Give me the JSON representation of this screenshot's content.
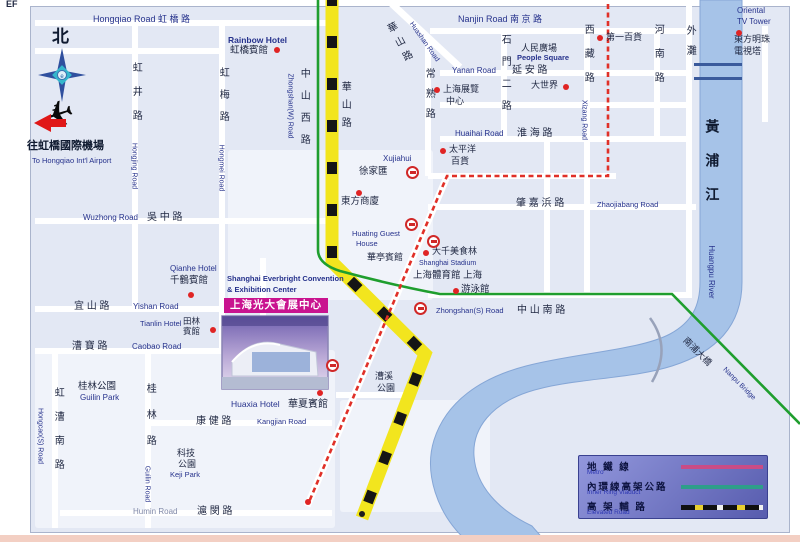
{
  "window": {
    "corner_text": "EF"
  },
  "colors": {
    "metro_line": "#e03028",
    "inner_ring_viaduct": "#1f9e2e",
    "elevated_road_yellow": "#f2e51e",
    "river": "#a6c3e8",
    "banner": "#c9138f",
    "landmark_dot": "#e02424",
    "navy_text": "#26328c"
  },
  "convention": {
    "en_line1": "Shanghai Everbright Convention",
    "en_line2": "& Exhibition Center",
    "banner": "上海光大會展中心"
  },
  "legend": {
    "rows": [
      {
        "zh": "地 鐵 線",
        "en": "Metro",
        "type": "metro"
      },
      {
        "zh": "內環線高架公路",
        "en": "Inner Ring Viaduct",
        "type": "ring"
      },
      {
        "zh": "高 架 輔 路",
        "en": "Elevated Road",
        "type": "elevated"
      }
    ]
  },
  "labels": [
    {
      "n": "corner-ef",
      "t": "EF",
      "x": 6,
      "y": 0,
      "fs": 9,
      "b": 1
    },
    {
      "n": "road-hongqiao",
      "t": "Hongqiao Road 虹 橋 路",
      "x": 93,
      "y": 15,
      "fs": 9,
      "c": "navy"
    },
    {
      "n": "compass-north",
      "t": "北",
      "x": 52,
      "y": 28,
      "fs": 17,
      "b": 1,
      "c": "dark2"
    },
    {
      "n": "airport-zh",
      "t": "往虹橋國際機場",
      "x": 27,
      "y": 141,
      "fs": 11,
      "b": 1,
      "c": "dark2"
    },
    {
      "n": "airport-en",
      "t": "To Hongqiao Int'l Airport",
      "x": 32,
      "y": 157,
      "fs": 7.5,
      "c": "navy"
    },
    {
      "n": "road-hongjing-zh",
      "t": "虹井路",
      "x": 135,
      "y": 98,
      "fs": 10,
      "v": 1,
      "ls": 14
    },
    {
      "n": "road-hongjing-en",
      "t": "Hongjing Road",
      "x": 134,
      "y": 166,
      "fs": 7,
      "rot": 90,
      "c": "navy"
    },
    {
      "n": "road-hongmei-zh",
      "t": "虹梅路",
      "x": 222,
      "y": 100,
      "fs": 10,
      "v": 1,
      "ls": 12
    },
    {
      "n": "road-hongmei-en",
      "t": "Hongmei Road",
      "x": 221,
      "y": 168,
      "fs": 7,
      "rot": 90,
      "c": "navy"
    },
    {
      "n": "road-zhongshanw-zh",
      "t": "中山西路",
      "x": 303,
      "y": 112,
      "fs": 10,
      "v": 1,
      "ls": 12
    },
    {
      "n": "road-zhongshanw-en",
      "t": "Zhongshan(W) Road",
      "x": 290,
      "y": 106,
      "fs": 7,
      "rot": 90,
      "c": "navy"
    },
    {
      "n": "rainbow-hotel-en",
      "t": "Rainbow Hotel",
      "x": 228,
      "y": 36,
      "fs": 8.5,
      "b": 1,
      "c": "navy"
    },
    {
      "n": "rainbow-hotel-zh",
      "t": "虹橋賓館",
      "x": 230,
      "y": 46,
      "fs": 9.5
    },
    {
      "n": "road-huashan-diag-zh",
      "t": "華山路",
      "x": 399,
      "y": 45,
      "fs": 10,
      "v": 1,
      "rot": -28,
      "ls": 6
    },
    {
      "n": "road-huashan-diag-en",
      "t": "Huashan Road",
      "x": 424,
      "y": 42,
      "fs": 7,
      "rot": 55,
      "c": "navy"
    },
    {
      "n": "road-huashan-zh",
      "t": "華山路",
      "x": 344,
      "y": 108,
      "fs": 10,
      "v": 1,
      "ls": 8
    },
    {
      "n": "road-changshu-zh",
      "t": "常熟路",
      "x": 428,
      "y": 98,
      "fs": 10,
      "v": 1,
      "ls": 10
    },
    {
      "n": "road-nanjing",
      "t": "Nanjin Road 南 京 路",
      "x": 458,
      "y": 15,
      "fs": 9,
      "c": "navy"
    },
    {
      "n": "road-shimen-zh",
      "t": "石門二路",
      "x": 504,
      "y": 78,
      "fs": 10,
      "v": 1,
      "ls": 12
    },
    {
      "n": "people-square-zh",
      "t": "人民廣場",
      "x": 521,
      "y": 44,
      "fs": 9
    },
    {
      "n": "people-square-en",
      "t": "People Square",
      "x": 517,
      "y": 54,
      "fs": 7.5,
      "b": 1,
      "c": "navy"
    },
    {
      "n": "road-yanan-en",
      "t": "Yanan Road",
      "x": 452,
      "y": 67,
      "fs": 8,
      "c": "navy"
    },
    {
      "n": "road-yanan-zh",
      "t": "延 安 路",
      "x": 512,
      "y": 66,
      "fs": 10
    },
    {
      "n": "great-world-zh",
      "t": "大世界",
      "x": 531,
      "y": 81,
      "fs": 9
    },
    {
      "n": "exhibition-zh",
      "t": "上海展覽",
      "x": 443,
      "y": 85,
      "fs": 9
    },
    {
      "n": "exhibition-zh2",
      "t": "中心",
      "x": 446,
      "y": 97,
      "fs": 9
    },
    {
      "n": "road-xizang-zh",
      "t": "西藏路",
      "x": 587,
      "y": 60,
      "fs": 10,
      "v": 1,
      "ls": 14
    },
    {
      "n": "road-xizang-en",
      "t": "Xizang Road",
      "x": 584,
      "y": 120,
      "fs": 7,
      "rot": 90,
      "c": "navy"
    },
    {
      "n": "no1-store-zh",
      "t": "第一百貨",
      "x": 606,
      "y": 33,
      "fs": 9
    },
    {
      "n": "road-henan-zh",
      "t": "河南路",
      "x": 657,
      "y": 60,
      "fs": 10,
      "v": 1,
      "ls": 14
    },
    {
      "n": "bund-zh",
      "t": "外灘",
      "x": 689,
      "y": 45,
      "fs": 10,
      "v": 1,
      "ls": 10
    },
    {
      "n": "oriental-en1",
      "t": "Oriental",
      "x": 737,
      "y": 7,
      "fs": 8,
      "c": "navy"
    },
    {
      "n": "oriental-en2",
      "t": "TV Tower",
      "x": 737,
      "y": 18,
      "fs": 8,
      "c": "navy"
    },
    {
      "n": "oriental-zh1",
      "t": "東方明珠",
      "x": 734,
      "y": 35,
      "fs": 9
    },
    {
      "n": "oriental-zh2",
      "t": "電視塔",
      "x": 734,
      "y": 47,
      "fs": 9
    },
    {
      "n": "road-huaihai-en",
      "t": "Huaihai Road",
      "x": 455,
      "y": 130,
      "fs": 8,
      "c": "navy"
    },
    {
      "n": "road-huaihai-zh",
      "t": "淮 海 路",
      "x": 517,
      "y": 129,
      "fs": 10
    },
    {
      "n": "pacific-zh1",
      "t": "太平洋",
      "x": 449,
      "y": 145,
      "fs": 9
    },
    {
      "n": "pacific-zh2",
      "t": "百貨",
      "x": 451,
      "y": 157,
      "fs": 9
    },
    {
      "n": "xujiahui-en",
      "t": "Xujiahui",
      "x": 383,
      "y": 155,
      "fs": 8,
      "c": "navy"
    },
    {
      "n": "xujiahui-zh",
      "t": "徐家匯",
      "x": 359,
      "y": 167,
      "fs": 9.5
    },
    {
      "n": "road-zhaojiabang-zh",
      "t": "肇 嘉 浜 路",
      "x": 516,
      "y": 199,
      "fs": 10
    },
    {
      "n": "road-zhaojiabang-en",
      "t": "Zhaojiabang Road",
      "x": 597,
      "y": 201,
      "fs": 7.5,
      "c": "navy"
    },
    {
      "n": "oriental-mall-zh",
      "t": "東方商廈",
      "x": 341,
      "y": 197,
      "fs": 9.5
    },
    {
      "n": "road-wuzhong-en",
      "t": "Wuzhong Road",
      "x": 83,
      "y": 214,
      "fs": 8,
      "c": "navy"
    },
    {
      "n": "road-wuzhong-zh",
      "t": "吳 中 路",
      "x": 147,
      "y": 213,
      "fs": 10
    },
    {
      "n": "huating-en1",
      "t": "Huating Guest",
      "x": 352,
      "y": 230,
      "fs": 7.5,
      "c": "navy"
    },
    {
      "n": "huating-en2",
      "t": "House",
      "x": 356,
      "y": 240,
      "fs": 7.5,
      "c": "navy"
    },
    {
      "n": "huating-zh",
      "t": "華亭賓館",
      "x": 367,
      "y": 253,
      "fs": 9
    },
    {
      "n": "daqian-zh",
      "t": "大千美食林",
      "x": 432,
      "y": 247,
      "fs": 9
    },
    {
      "n": "stadium-en",
      "t": "Shanghai Stadium",
      "x": 419,
      "y": 260,
      "fs": 7,
      "c": "navy"
    },
    {
      "n": "stadium-zh",
      "t": "上海體育館 上海",
      "x": 413,
      "y": 271,
      "fs": 9.5
    },
    {
      "n": "natatorium-zh",
      "t": "游泳館",
      "x": 461,
      "y": 285,
      "fs": 9.5
    },
    {
      "n": "qianhe-en",
      "t": "Qianhe Hotel",
      "x": 170,
      "y": 265,
      "fs": 8,
      "c": "navy"
    },
    {
      "n": "qianhe-zh",
      "t": "千鶴賓館",
      "x": 170,
      "y": 276,
      "fs": 9.5
    },
    {
      "n": "road-zhongshans-en",
      "t": "Zhongshan(S) Road",
      "x": 436,
      "y": 307,
      "fs": 7.5,
      "c": "navy"
    },
    {
      "n": "road-zhongshans-zh",
      "t": "中 山 南 路",
      "x": 517,
      "y": 306,
      "fs": 10
    },
    {
      "n": "road-yishan-zh",
      "t": "宜 山 路",
      "x": 74,
      "y": 302,
      "fs": 10
    },
    {
      "n": "road-yishan-en",
      "t": "Yishan Road",
      "x": 133,
      "y": 303,
      "fs": 8,
      "c": "navy"
    },
    {
      "n": "tianlin-en",
      "t": "Tianlin Hotel",
      "x": 140,
      "y": 320,
      "fs": 7.5,
      "c": "navy"
    },
    {
      "n": "tianlin-zh1",
      "t": "田林",
      "x": 183,
      "y": 317,
      "fs": 8.5
    },
    {
      "n": "tianlin-zh2",
      "t": "賓館",
      "x": 183,
      "y": 327,
      "fs": 8.5
    },
    {
      "n": "road-caobao-zh",
      "t": "漕 寶 路",
      "x": 72,
      "y": 342,
      "fs": 10
    },
    {
      "n": "road-caobao-en",
      "t": "Caobao Road",
      "x": 132,
      "y": 343,
      "fs": 8,
      "c": "navy"
    },
    {
      "n": "caoxi-park-zh1",
      "t": "漕溪",
      "x": 375,
      "y": 372,
      "fs": 9
    },
    {
      "n": "caoxi-park-zh2",
      "t": "公園",
      "x": 377,
      "y": 384,
      "fs": 9
    },
    {
      "n": "guilin-park-zh",
      "t": "桂林公園",
      "x": 78,
      "y": 382,
      "fs": 9.5
    },
    {
      "n": "guilin-park-en",
      "t": "Guilin Park",
      "x": 80,
      "y": 394,
      "fs": 8,
      "c": "navy"
    },
    {
      "n": "road-hongcao-zh",
      "t": "虹漕南路",
      "x": 57,
      "y": 435,
      "fs": 10,
      "v": 1,
      "ls": 14
    },
    {
      "n": "road-hongcao-en",
      "t": "Hongcao(S) Road",
      "x": 40,
      "y": 436,
      "fs": 7,
      "rot": 90,
      "c": "navy"
    },
    {
      "n": "road-guilin-zh",
      "t": "桂林路",
      "x": 149,
      "y": 422,
      "fs": 10,
      "v": 1,
      "ls": 16
    },
    {
      "n": "road-guilin-en",
      "t": "Guilin Road",
      "x": 147,
      "y": 484,
      "fs": 7,
      "rot": 90,
      "c": "navy"
    },
    {
      "n": "huaxia-en",
      "t": "Huaxia Hotel",
      "x": 231,
      "y": 400,
      "fs": 8.5,
      "c": "navy"
    },
    {
      "n": "huaxia-zh",
      "t": "華夏賓館",
      "x": 288,
      "y": 400,
      "fs": 10
    },
    {
      "n": "road-kangjian-zh",
      "t": "康 健 路",
      "x": 196,
      "y": 417,
      "fs": 10
    },
    {
      "n": "road-kangjian-en",
      "t": "Kangjian Road",
      "x": 257,
      "y": 418,
      "fs": 7.5,
      "c": "navy"
    },
    {
      "n": "keji-park-zh1",
      "t": "科技",
      "x": 177,
      "y": 449,
      "fs": 9
    },
    {
      "n": "keji-park-zh2",
      "t": "公園",
      "x": 178,
      "y": 460,
      "fs": 9
    },
    {
      "n": "keji-park-en",
      "t": "Keji Park",
      "x": 170,
      "y": 471,
      "fs": 7.5,
      "c": "navy"
    },
    {
      "n": "road-humin-en",
      "t": "Humin Road",
      "x": 133,
      "y": 508,
      "fs": 8,
      "c": "gray"
    },
    {
      "n": "road-humin-zh",
      "t": "滬 閔 路",
      "x": 197,
      "y": 507,
      "fs": 10
    },
    {
      "n": "river-zh",
      "t": "黃浦江",
      "x": 712,
      "y": 170,
      "fs": 14,
      "v": 1,
      "ls": 20,
      "b": 1,
      "c": "dark2"
    },
    {
      "n": "river-en",
      "t": "Huangpu River",
      "x": 711,
      "y": 272,
      "fs": 8,
      "rot": 90,
      "c": "navy"
    },
    {
      "n": "bridge-zh",
      "t": "南浦大橋",
      "x": 697,
      "y": 352,
      "fs": 9,
      "rot": 45
    },
    {
      "n": "bridge-en",
      "t": "Nanpu Bridge",
      "x": 739,
      "y": 384,
      "fs": 7,
      "rot": 45,
      "c": "navy"
    }
  ],
  "landmark_dots": [
    [
      277,
      50
    ],
    [
      437,
      90
    ],
    [
      566,
      87
    ],
    [
      600,
      38
    ],
    [
      739,
      33
    ],
    [
      443,
      151
    ],
    [
      191,
      295
    ],
    [
      213,
      330
    ],
    [
      359,
      193
    ],
    [
      320,
      393
    ],
    [
      426,
      253
    ],
    [
      456,
      291
    ],
    [
      308,
      502
    ]
  ],
  "dark_dots": [
    [
      362,
      514
    ]
  ],
  "metro_stations": [
    [
      412,
      172
    ],
    [
      411,
      224
    ],
    [
      433,
      241
    ],
    [
      420,
      308
    ],
    [
      332,
      365
    ]
  ],
  "roads": {
    "horizontal": [
      [
        35,
        20,
        300
      ],
      [
        430,
        28,
        262
      ],
      [
        35,
        48,
        190
      ],
      [
        440,
        70,
        252
      ],
      [
        440,
        102,
        252
      ],
      [
        440,
        136,
        252
      ],
      [
        428,
        173,
        188
      ],
      [
        428,
        204,
        268
      ],
      [
        35,
        218,
        292
      ],
      [
        428,
        292,
        264
      ],
      [
        35,
        306,
        192
      ],
      [
        35,
        348,
        192
      ],
      [
        150,
        420,
        182
      ],
      [
        60,
        510,
        272
      ],
      [
        336,
        392,
        72
      ]
    ],
    "vertical": [
      [
        132,
        20,
        292
      ],
      [
        219,
        20,
        334
      ],
      [
        52,
        352,
        176
      ],
      [
        145,
        352,
        176
      ],
      [
        425,
        36,
        140
      ],
      [
        501,
        28,
        112
      ],
      [
        584,
        28,
        268
      ],
      [
        654,
        28,
        112
      ],
      [
        686,
        0,
        296
      ],
      [
        544,
        140,
        156
      ],
      [
        762,
        26,
        96
      ],
      [
        260,
        258,
        96
      ]
    ],
    "diagonal": [
      [
        388,
        5,
        95,
        -47
      ],
      [
        443,
        177,
        356,
        23
      ]
    ]
  },
  "patches": [
    [
      228,
      150,
      205,
      150
    ],
    [
      35,
      350,
      300,
      178
    ],
    [
      340,
      400,
      150,
      112
    ]
  ],
  "bridges_top": [
    [
      694,
      63
    ],
    [
      694,
      77
    ]
  ]
}
